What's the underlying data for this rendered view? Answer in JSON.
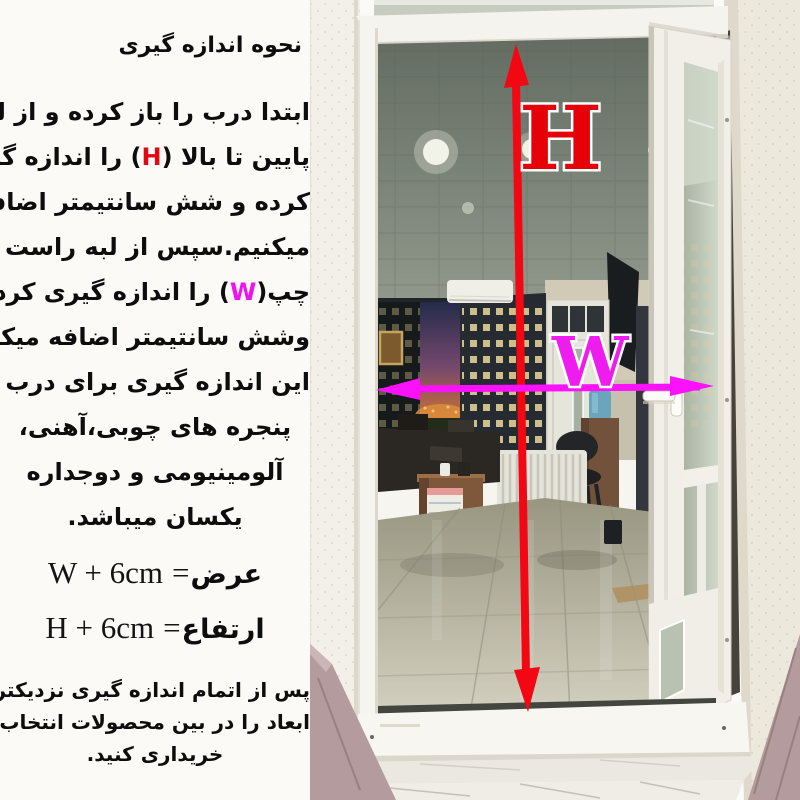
{
  "colors": {
    "h_red": "#e30613",
    "w_magenta": "#ef12ef",
    "arrow_red": "#f20712",
    "arrow_magenta": "#fb12fb",
    "background": "#fcfaf7"
  },
  "left_panel": {
    "title": "نحوه اندازه گیری",
    "para": {
      "l1": "ابتدا درب را باز کرده و از لبه",
      "l2a": "پایین تا بالا ",
      "l2b": "(",
      "l2c": "H",
      "l2d": ")",
      "l2e": " را اندازه گیری",
      "l3": "کرده و شش سانتیمتر اضافه",
      "l4": "میکنیم.سپس از لبه راست تا",
      "l5a": "چپ",
      "l5b": "(",
      "l5c": "W",
      "l5d": ")",
      "l5e": " را اندازه گیری کرده",
      "l6": "وشش سانتیمتر اضافه میکنیم.",
      "l7": "این اندازه گیری برای درب و",
      "l8": "پنجره های چوبی،آهنی،",
      "l9": "آلومینیومی و دوجداره",
      "l10": "یکسان میباشد."
    },
    "formulas": [
      {
        "latin": "W + 6cm",
        "eq": "=",
        "label": "عرض"
      },
      {
        "latin": "H + 6cm",
        "eq": "=",
        "label": "ارتفاع"
      }
    ],
    "footer": [
      "پس از اتمام اندازه گیری نزدیکترین",
      "ابعاد را در بین محصولات انتخاب و",
      "خریداری کنید."
    ]
  },
  "photo": {
    "h_label": "H",
    "w_label": "W"
  }
}
